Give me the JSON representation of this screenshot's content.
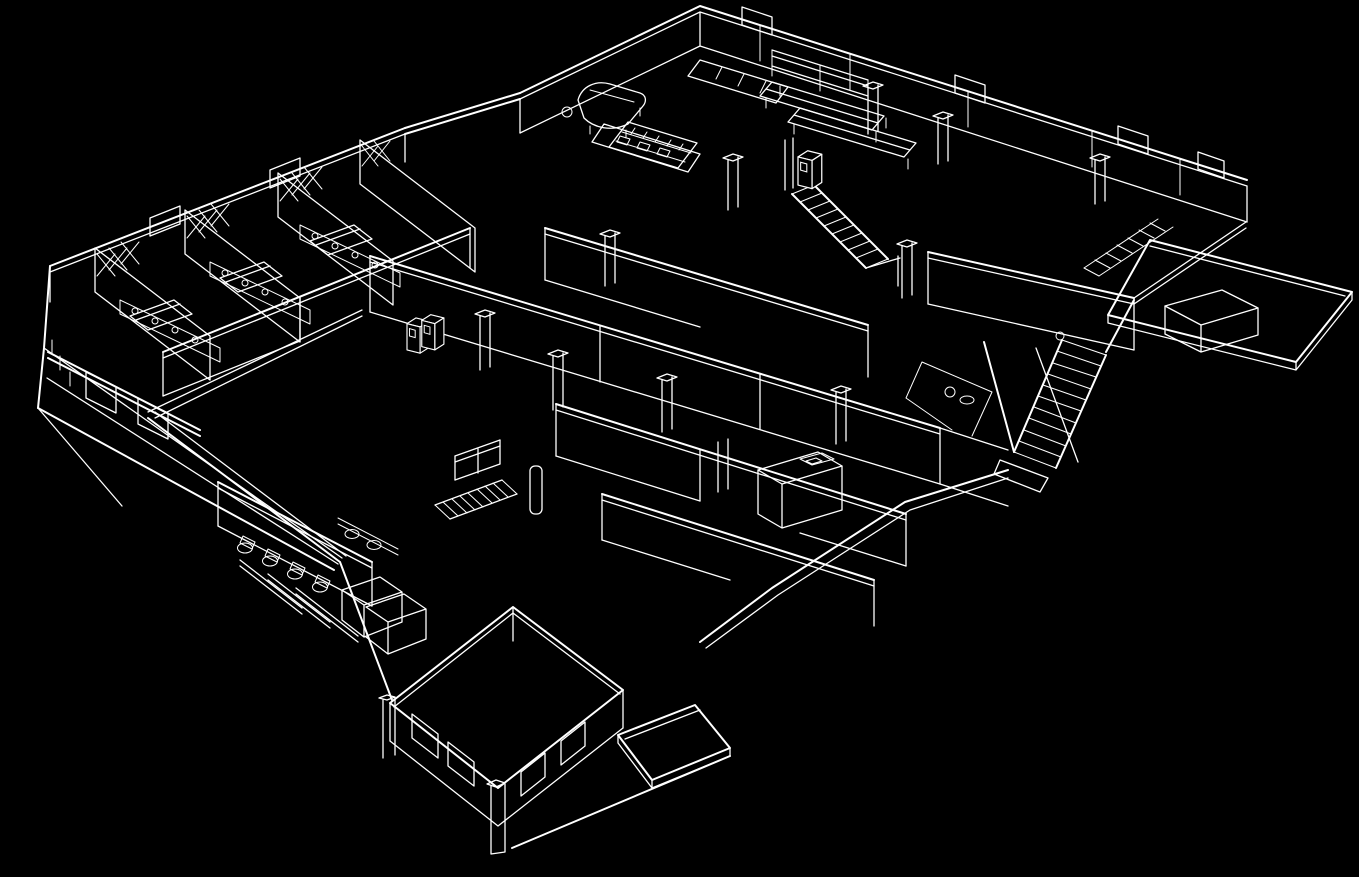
{
  "meta": {
    "scene": "isometric-cutaway-wireframe-floorplan",
    "render_style": "white outlines on black background",
    "visible_text": ""
  },
  "canvas": {
    "width": 1359,
    "height": 877,
    "background": "#000000",
    "line_color": "#ffffff"
  },
  "markers": [
    {
      "id": "cabinet-pair",
      "name": "highlighted-red-cabinet-pair",
      "location": "main-corridor",
      "units": 2,
      "color": "#c1272d",
      "top_color": "#d03a41",
      "x": 407,
      "y": 313,
      "scale": 0.82
    },
    {
      "id": "cabinet-single",
      "name": "highlighted-red-cabinet",
      "location": "upper-stair-landing",
      "units": 1,
      "color": "#c1272d",
      "top_color": "#d03a41",
      "x": 798,
      "y": 149,
      "scale": 0.88
    }
  ],
  "features": [
    {
      "id": "dorm-wing",
      "label": "dormitory wing with lattice partitions and beds"
    },
    {
      "id": "entry-ramp-west",
      "label": "west entry ramp"
    },
    {
      "id": "main-corridor",
      "label": "main diagonal corridor"
    },
    {
      "id": "common-room",
      "label": "common room with grand piano and keyboard console"
    },
    {
      "id": "dining-area",
      "label": "long dining tables"
    },
    {
      "id": "kitchen-counter",
      "label": "kitchen counter with appliances"
    },
    {
      "id": "upper-staircase",
      "label": "staircase beside single red cabinet"
    },
    {
      "id": "switchback-staircase",
      "label": "east switchback staircase"
    },
    {
      "id": "east-terrace",
      "label": "east terrace deck with bench"
    },
    {
      "id": "bathroom",
      "label": "bathroom with four toilets and two sinks"
    },
    {
      "id": "lower-stairwell",
      "label": "railed stairwell to lower level"
    },
    {
      "id": "south-room",
      "label": "south room with window openings"
    },
    {
      "id": "south-porch",
      "label": "south porch platform"
    },
    {
      "id": "support-columns",
      "label": "support columns"
    },
    {
      "id": "printer-cabinet",
      "label": "cabinet unit with box"
    }
  ]
}
